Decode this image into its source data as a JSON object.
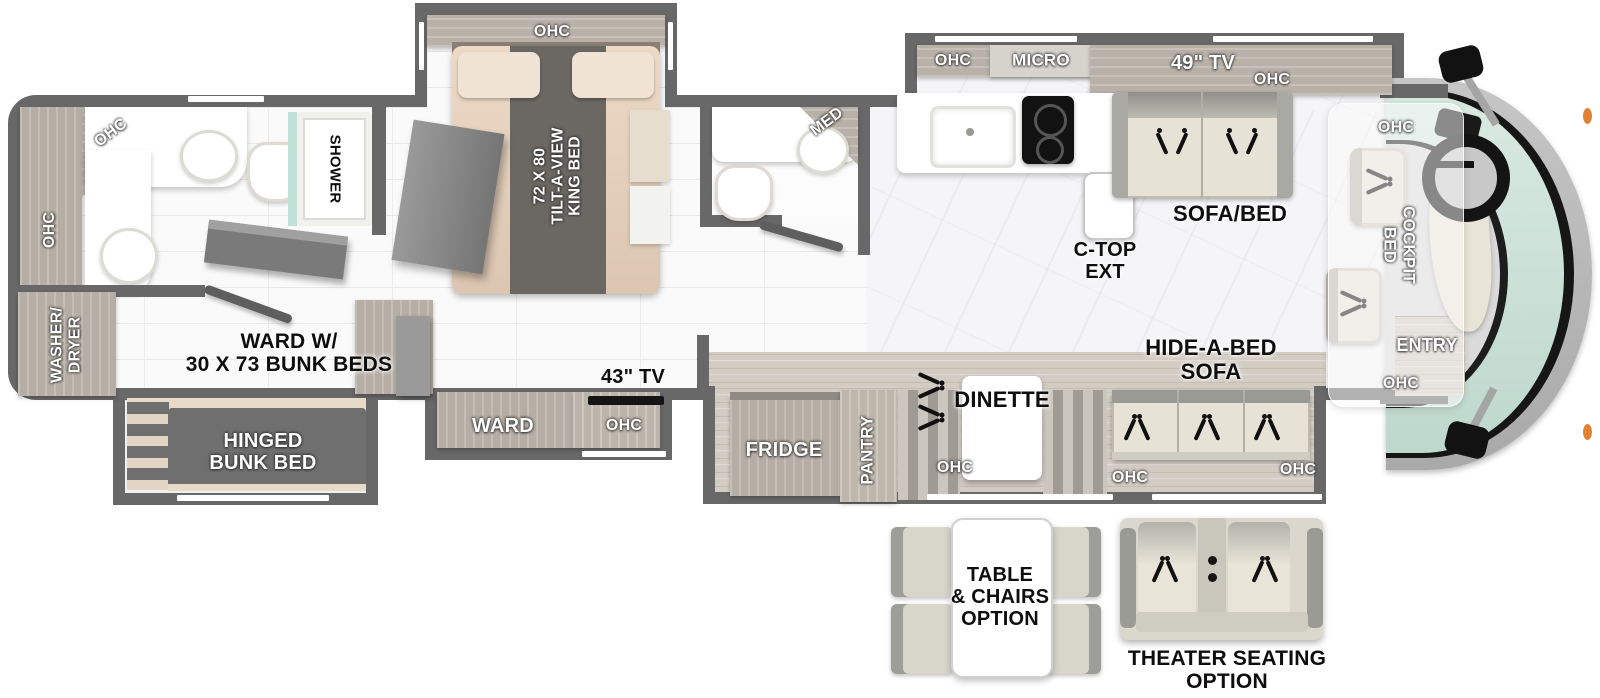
{
  "title": "RV motorhome floorplan",
  "colors": {
    "wall": "#686868",
    "cabinet_wood": "#b6aea4",
    "wood_floor": "#d3ccc3",
    "windshield_glass": "#cfe3da",
    "marker_light": "#e08030",
    "bed_fabric": "#e8d4c0",
    "sofa_fabric": "#e6e2d5"
  },
  "labels": {
    "ohc": "OHC",
    "micro": "MICRO",
    "tv49": "49\" TV",
    "tv43": "43\" TV",
    "med": "MED",
    "shower": "SHOWER",
    "washer_dryer": "WASHER/\nDRYER",
    "ward_bunks": "WARD W/\n30 X 73 BUNK BEDS",
    "hinged_bunk": "HINGED\nBUNK BED",
    "king_bed": "72 X 80\nTILT-A-VIEW\nKING BED",
    "ward": "WARD",
    "fridge": "FRIDGE",
    "pantry": "PANTRY",
    "dinette": "DINETTE",
    "sofa_bed": "SOFA/BED",
    "ctop_ext": "C-TOP\nEXT",
    "hide_a_bed": "HIDE-A-BED\nSOFA",
    "cockpit_bed": "COCKPIT\nBED",
    "entry": "ENTRY",
    "table_chairs_option": "TABLE\n& CHAIRS\nOPTION",
    "theater_option": "THEATER SEATING\nOPTION"
  }
}
